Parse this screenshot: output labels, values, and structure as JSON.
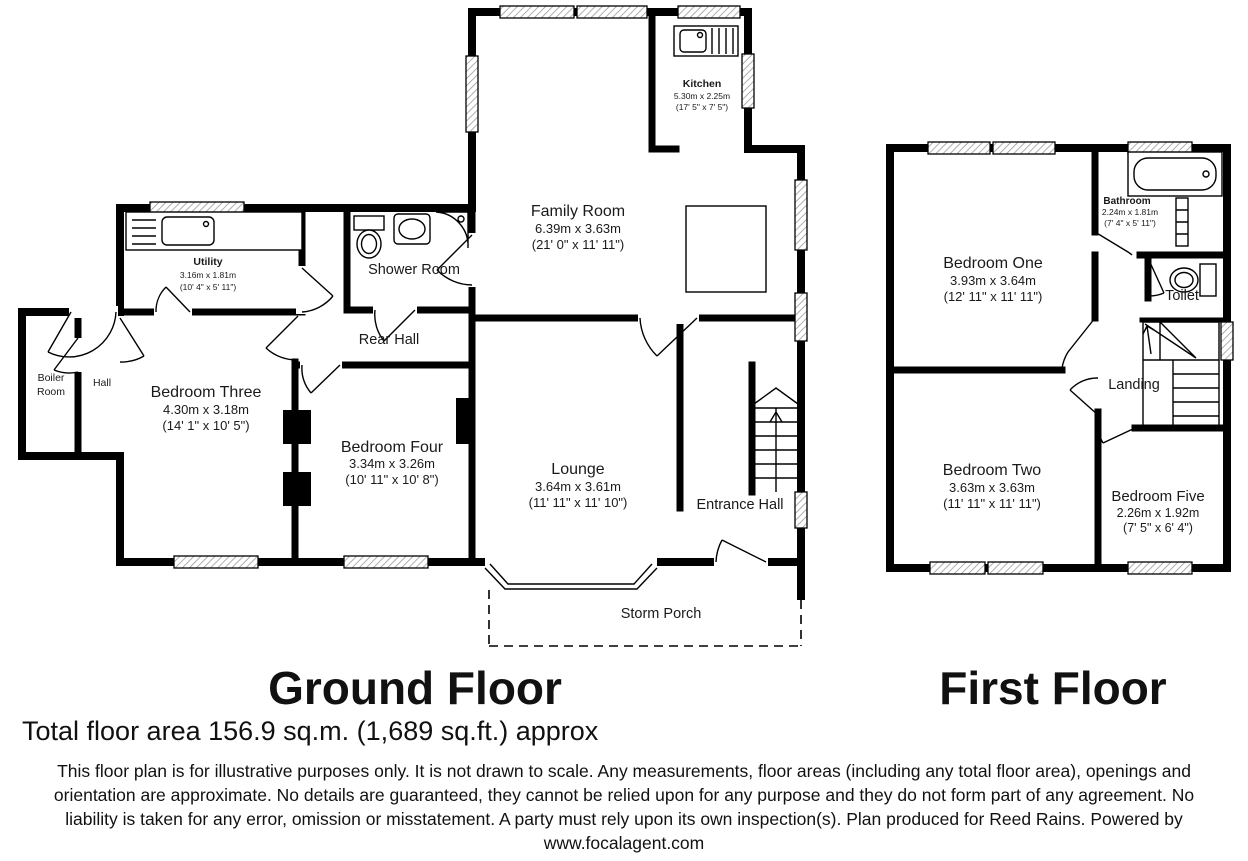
{
  "titles": {
    "ground": "Ground Floor",
    "first": "First Floor",
    "total_area": "Total floor area 156.9 sq.m. (1,689 sq.ft.) approx"
  },
  "disclaimer": {
    "line1": "This floor plan is for illustrative purposes only. It is not drawn to scale. Any measurements, floor areas (including any total floor area), openings and",
    "line2": "orientation are approximate. No details are guaranteed, they cannot be relied upon for any purpose and they do not form part of any agreement. No",
    "line3": "liability is taken for any error, omission or misstatement. A party must rely upon its own inspection(s). Plan produced for Reed Rains. Powered by",
    "line4": "www.focalagent.com"
  },
  "ground_floor": {
    "kitchen": {
      "name": "Kitchen",
      "metric": "5.30m x 2.25m",
      "imperial": "(17' 5\" x 7' 5\")"
    },
    "family_room": {
      "name": "Family Room",
      "metric": "6.39m x 3.63m",
      "imperial": "(21' 0\" x 11' 11\")"
    },
    "shower_room": {
      "name": "Shower Room"
    },
    "rear_hall": {
      "name": "Rear Hall"
    },
    "utility": {
      "name": "Utility",
      "metric": "3.16m x 1.81m",
      "imperial": "(10' 4\" x 5' 11\")"
    },
    "boiler_room": {
      "line1": "Boiler",
      "line2": "Room"
    },
    "hall": {
      "name": "Hall"
    },
    "bedroom_three": {
      "name": "Bedroom Three",
      "metric": "4.30m x 3.18m",
      "imperial": "(14' 1\" x 10' 5\")"
    },
    "bedroom_four": {
      "name": "Bedroom Four",
      "metric": "3.34m x 3.26m",
      "imperial": "(10' 11\" x 10' 8\")"
    },
    "lounge": {
      "name": "Lounge",
      "metric": "3.64m x 3.61m",
      "imperial": "(11' 11\" x 11' 10\")"
    },
    "entrance_hall": {
      "name": "Entrance Hall"
    },
    "storm_porch": {
      "name": "Storm Porch"
    }
  },
  "first_floor": {
    "bathroom": {
      "name": "Bathroom",
      "metric": "2.24m x 1.81m",
      "imperial": "(7' 4\" x 5' 11\")"
    },
    "bedroom_one": {
      "name": "Bedroom One",
      "metric": "3.93m x 3.64m",
      "imperial": "(12' 11\" x 11' 11\")"
    },
    "toilet": {
      "name": "Toilet"
    },
    "landing": {
      "name": "Landing"
    },
    "bedroom_two": {
      "name": "Bedroom Two",
      "metric": "3.63m x 3.63m",
      "imperial": "(11' 11\" x 11' 11\")"
    },
    "bedroom_five": {
      "name": "Bedroom Five",
      "metric": "2.26m x 1.92m",
      "imperial": "(7' 5\" x 6' 4\")"
    }
  },
  "colors": {
    "wall": "#000000",
    "background": "#ffffff"
  }
}
